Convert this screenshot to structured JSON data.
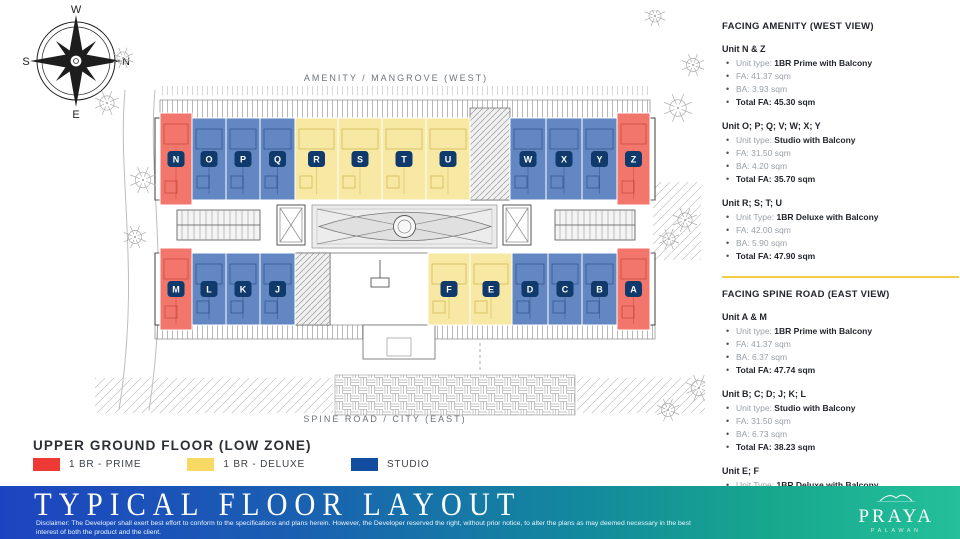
{
  "plan": {
    "west_label": "AMENITY / MANGROVE (WEST)",
    "east_label": "SPINE ROAD / CITY (EAST)",
    "compass": {
      "top": "W",
      "right": "N",
      "bottom": "E",
      "left": "S"
    },
    "badge_color": "#103A6B",
    "unit_colors": {
      "prime": "#F2766B",
      "deluxe": "#F7E9A4",
      "studio": "#6287C2"
    },
    "top_units": [
      {
        "label": "N",
        "type": "prime"
      },
      {
        "label": "O",
        "type": "studio"
      },
      {
        "label": "P",
        "type": "studio"
      },
      {
        "label": "Q",
        "type": "studio"
      },
      {
        "label": "R",
        "type": "deluxe"
      },
      {
        "label": "S",
        "type": "deluxe"
      },
      {
        "label": "T",
        "type": "deluxe"
      },
      {
        "label": "U",
        "type": "deluxe"
      },
      {
        "label": "W",
        "type": "studio"
      },
      {
        "label": "X",
        "type": "studio"
      },
      {
        "label": "Y",
        "type": "studio"
      },
      {
        "label": "Z",
        "type": "prime"
      }
    ],
    "bottom_units": [
      {
        "label": "M",
        "type": "prime"
      },
      {
        "label": "L",
        "type": "studio"
      },
      {
        "label": "K",
        "type": "studio"
      },
      {
        "label": "J",
        "type": "studio"
      },
      {
        "label": "F",
        "type": "deluxe"
      },
      {
        "label": "E",
        "type": "deluxe"
      },
      {
        "label": "D",
        "type": "studio"
      },
      {
        "label": "C",
        "type": "studio"
      },
      {
        "label": "B",
        "type": "studio"
      },
      {
        "label": "A",
        "type": "prime"
      }
    ]
  },
  "panel": {
    "sections": [
      {
        "heading": "FACING AMENITY (WEST VIEW)",
        "groups": [
          {
            "title": "Unit N & Z",
            "rows": [
              {
                "muted": "Unit type: ",
                "strong": "1BR Prime with Balcony"
              },
              {
                "muted": "FA: 41.37 sqm"
              },
              {
                "muted": "BA: 3.93 sqm"
              },
              {
                "strong": "Total FA: 45.30 sqm"
              }
            ]
          },
          {
            "title": "Unit O; P; Q; V; W; X; Y",
            "rows": [
              {
                "muted": "Unit type: ",
                "strong": "Studio with Balcony"
              },
              {
                "muted": "FA: 31.50 sqm"
              },
              {
                "muted": "BA: 4.20 sqm"
              },
              {
                "strong": "Total FA: 35.70 sqm"
              }
            ]
          },
          {
            "title": "Unit R; S; T; U",
            "rows": [
              {
                "muted": "Unit Type: ",
                "strong": "1BR Deluxe with Balcony"
              },
              {
                "muted": "FA: 42.00 sqm"
              },
              {
                "muted": "BA: 5.90 sqm"
              },
              {
                "strong": "Total FA: 47.90 sqm"
              }
            ]
          }
        ]
      },
      {
        "heading": "FACING SPINE ROAD (EAST VIEW)",
        "groups": [
          {
            "title": "Unit A & M",
            "rows": [
              {
                "muted": "Unit type: ",
                "strong": "1BR Prime with Balcony"
              },
              {
                "muted": "FA: 41.37 sqm"
              },
              {
                "muted": "BA: 6.37 sqm"
              },
              {
                "strong": "Total FA: 47.74 sqm"
              }
            ]
          },
          {
            "title": "Unit B; C; D; J; K; L",
            "rows": [
              {
                "muted": "Unit type: ",
                "strong": "Studio with Balcony"
              },
              {
                "muted": "FA: 31.50 sqm"
              },
              {
                "muted": "BA: 6.73 sqm"
              },
              {
                "strong": "Total FA: 38.23 sqm"
              }
            ]
          },
          {
            "title": "Unit E; F",
            "rows": [
              {
                "muted": "Unit Type: ",
                "strong": "1BR Deluxe with Balcony"
              },
              {
                "muted": "FA: 42.00 sqm"
              },
              {
                "muted": "BA: 8.73 sqm"
              },
              {
                "strong": "Total FA: 50.73 sqm"
              }
            ]
          }
        ]
      }
    ]
  },
  "legend": {
    "title": "UPPER GROUND FLOOR (LOW ZONE)",
    "items": [
      {
        "label": "1 BR - PRIME",
        "color": "#EE3A34"
      },
      {
        "label": "1 BR - DELUXE",
        "color": "#F7D964"
      },
      {
        "label": "STUDIO",
        "color": "#134DA0"
      }
    ]
  },
  "footer": {
    "title": "TYPICAL FLOOR LAYOUT",
    "disclaimer": "Disclaimer: The Developer shall exert best effort to conform to the specifications and plans herein. However, the Developer reserved the right, without prior notice, to alter the plans as may deemed necessary in the best interest of both the product and the client.",
    "brand_name": "PRAYA",
    "brand_sub": "PALAWAN"
  }
}
